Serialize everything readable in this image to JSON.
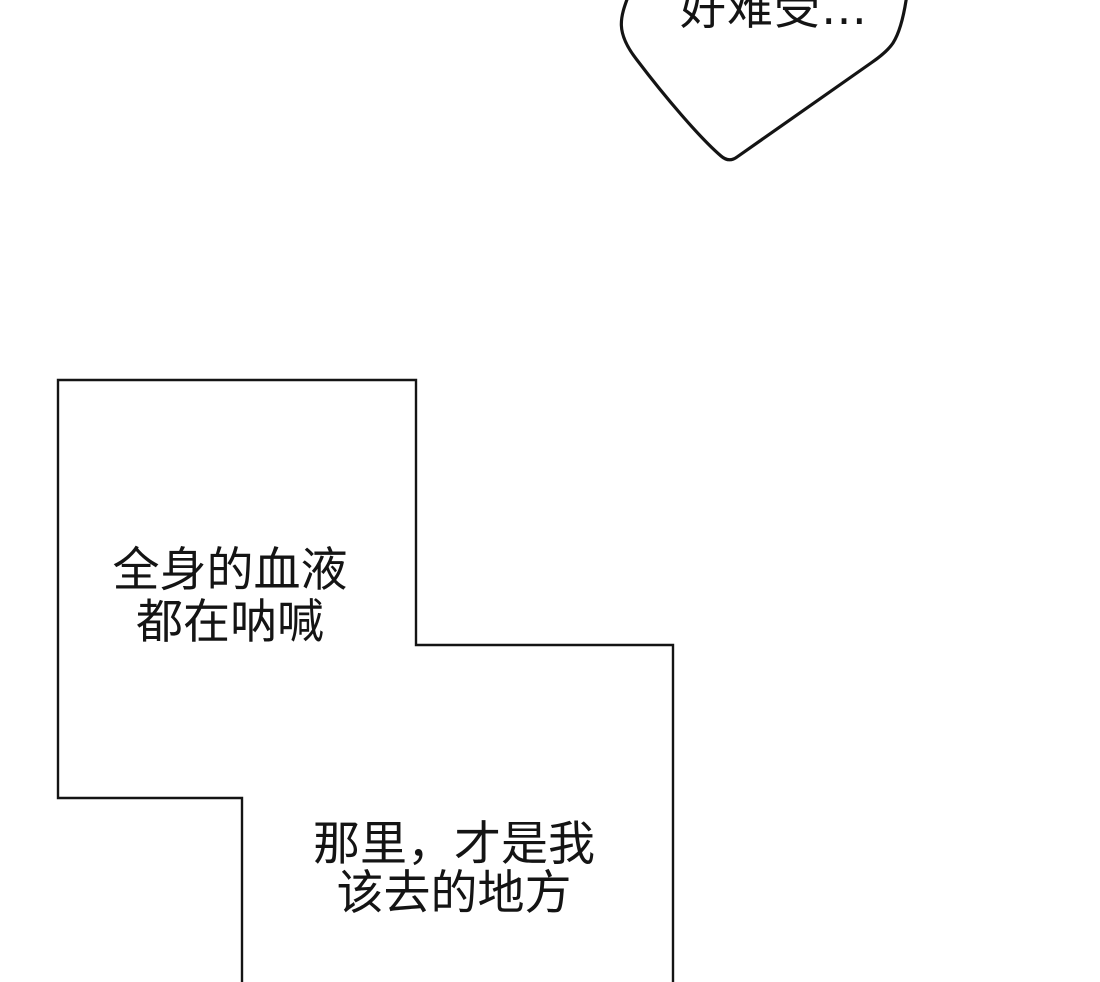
{
  "page": {
    "background_color": "#ffffff",
    "ink_color": "#141414"
  },
  "speech_bubble": {
    "text": "好难受…"
  },
  "panel": {
    "caption_blood": {
      "line1": "全身的血液",
      "line2": "都在呐喊"
    },
    "caption_place": {
      "line1": "那里，才是我",
      "line2": "该去的地方"
    }
  }
}
